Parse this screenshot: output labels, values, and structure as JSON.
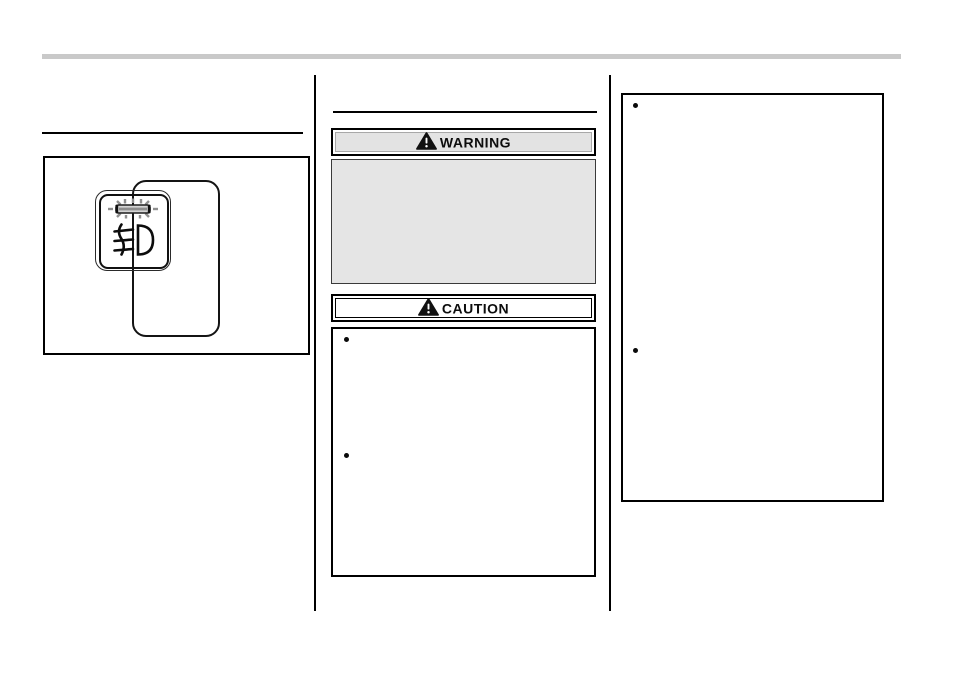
{
  "page": {
    "kind": "owners-manual-page",
    "background_color": "#ffffff",
    "header_bar_color": "#c9c9c9",
    "rule_color": "#000000"
  },
  "left_column": {
    "illustration": {
      "name": "fog-light-switch-illustration",
      "indicator_icon": "indicator-lamp-icon",
      "symbol_icon": "front-fog-light-icon",
      "ray_color": "#8f8f8f"
    }
  },
  "middle_column": {
    "warning_banner": {
      "label": "WARNING",
      "icon": "warning-triangle-icon",
      "fill_color": "#e3e3e3"
    },
    "warning_panel": {
      "fill_color": "#e5e5e5",
      "text": ""
    },
    "caution_banner": {
      "label": "CAUTION",
      "icon": "warning-triangle-icon",
      "fill_color": "#ffffff"
    },
    "caution_box": {
      "bullet_items": [
        "",
        ""
      ]
    }
  },
  "right_column": {
    "notes_box": {
      "bullet_items": [
        "",
        ""
      ]
    }
  }
}
